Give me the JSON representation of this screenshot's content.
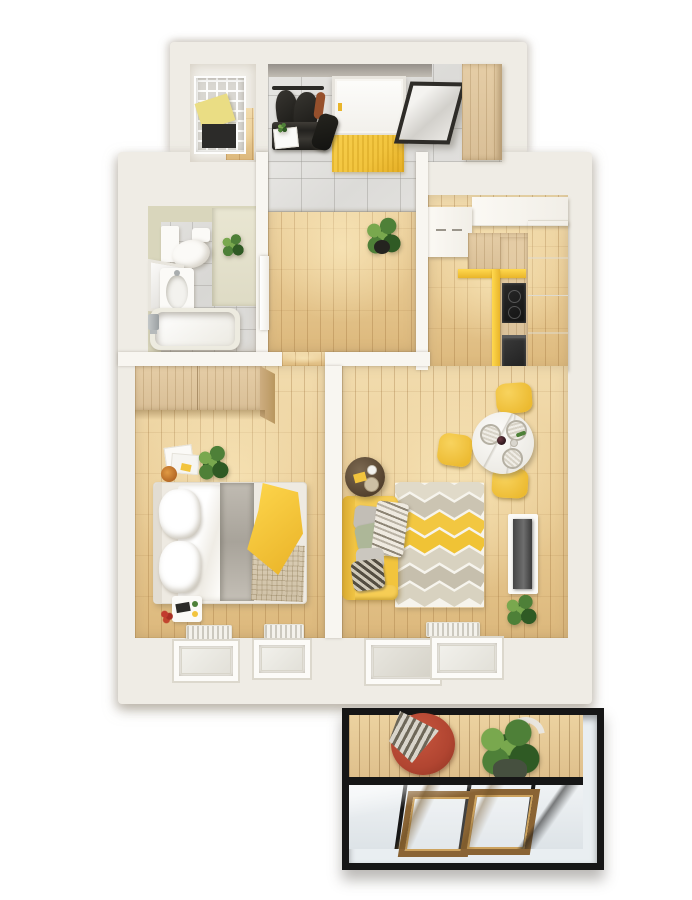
{
  "palette": {
    "background": "#ffffff",
    "wall": "#efece5",
    "interior_wall": "#f8f6f1",
    "wood_floor": "#e9cb94",
    "wood_floor_light": "#f2dcae",
    "wood_floor_dark": "#dcb87c",
    "marble_tile": "#dcdbd8",
    "bathroom_wall": "#d9d6bc",
    "accent_yellow": "#f2c43d",
    "accent_yellow_deep": "#e9b52a",
    "furniture_wood": "#d9bf97",
    "dark_item": "#262522",
    "gray_textile": "#b8b3aa",
    "green_plant": "#4e8038",
    "green_plant_dark": "#2f5a24",
    "green_plant_light": "#79a84e",
    "red_chair": "#b14531",
    "balcony_frame": "#161616",
    "glass": "#e9eef1",
    "window_sash_wood": "#8a6434",
    "white_furniture": "#fbfaf7"
  },
  "scene": {
    "type": "3d-floor-plan-render",
    "view": "top-down",
    "style": "one-bedroom apartment, white walls, light oak floors, yellow accents",
    "rooms": [
      {
        "name": "storage-closet",
        "floor": "light",
        "furniture": [
          "wire-shelving-unit",
          "yellow-storage-box",
          "black-storage-box"
        ]
      },
      {
        "name": "entrance-hall",
        "floor": "gray-marble-tile",
        "furniture": [
          "entry-door",
          "yellow-doormat",
          "coat-rack-with-jackets",
          "shoe-bench",
          "duffel-bag",
          "leaning-mirror",
          "wood-wardrobe"
        ]
      },
      {
        "name": "bathroom",
        "floor": "gray-marble-tile",
        "furniture": [
          "washer-cabinet",
          "toilet",
          "vanity-sink",
          "leaning-mirror",
          "bathtub",
          "potted-plant",
          "counter-ledge"
        ]
      },
      {
        "name": "hallway",
        "floor": "oak-planks",
        "furniture": [
          "potted-plant",
          "bathroom-door"
        ]
      },
      {
        "name": "kitchen",
        "floor": "oak-planks",
        "furniture": [
          "white-upper-cabinets",
          "wood-countertop",
          "yellow-kick-strip",
          "cooktop",
          "oven",
          "tall-white-cabinets"
        ]
      },
      {
        "name": "dining-area",
        "floor": "oak-planks",
        "furniture": [
          "round-marble-table",
          "placemats",
          "wine-bottle",
          "yellow-chair-north",
          "yellow-chair-west",
          "yellow-chair-south"
        ]
      },
      {
        "name": "living-room",
        "floor": "oak-planks",
        "furniture": [
          "yellow-sofa",
          "throw-pillows",
          "striped-throw",
          "chevron-rug",
          "round-coffee-table",
          "tv-on-stand",
          "potted-plant",
          "radiator",
          "balcony-door",
          "window"
        ]
      },
      {
        "name": "bedroom",
        "floor": "oak-planks",
        "furniture": [
          "wood-wardrobe",
          "double-bed",
          "white-pillows",
          "gray-blanket",
          "yellow-throw",
          "woven-blanket",
          "nightstand",
          "magazines",
          "potted-plant",
          "flowers",
          "two-windows",
          "two-radiators"
        ]
      },
      {
        "name": "balcony",
        "floor": "wood-deck",
        "furniture": [
          "red-papasan-chair",
          "patterned-blanket",
          "large-potted-plant",
          "black-glazed-frame",
          "wood-window-sashes"
        ]
      }
    ]
  }
}
